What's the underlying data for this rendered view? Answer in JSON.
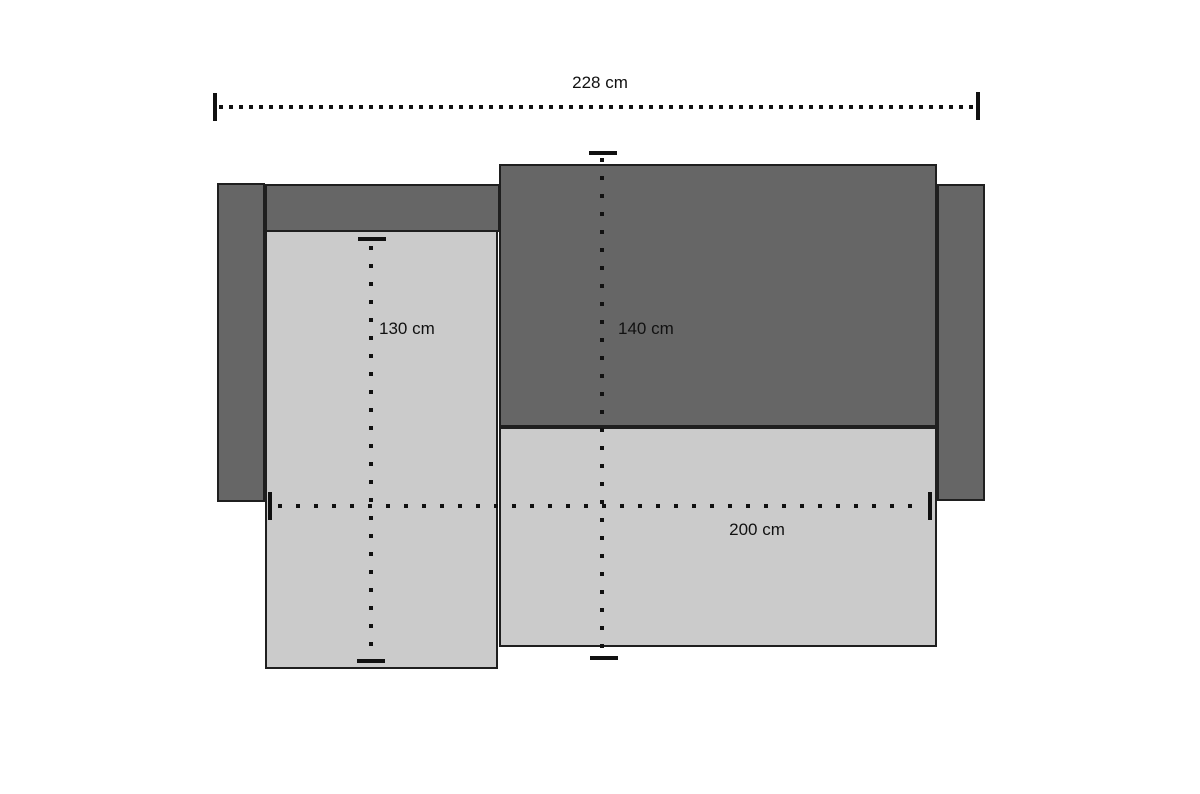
{
  "colors": {
    "bg": "#ffffff",
    "panel-dark": "#666666",
    "panel-light": "#cbcbcb",
    "outline": "#1f1f1f",
    "ink": "#111111"
  },
  "labels": {
    "overall_width": "228 cm",
    "chaise_length": "130 cm",
    "center_depth": "140 cm",
    "inner_width": "200 cm"
  }
}
